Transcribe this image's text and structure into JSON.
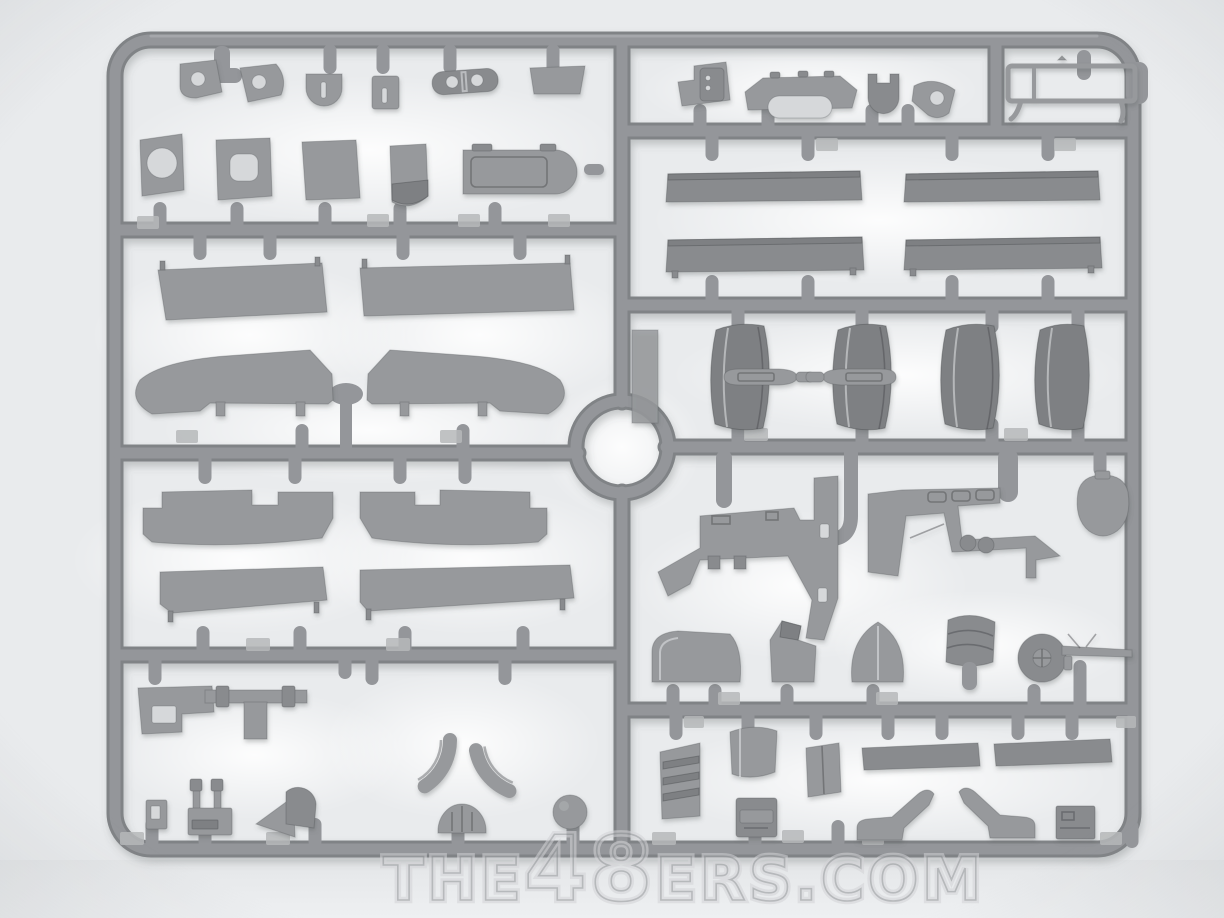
{
  "watermark": {
    "prefix": "THE",
    "number": "48",
    "suffix": "ERS.COM"
  },
  "colors": {
    "background": "#e9ebed",
    "runner": "#94969a",
    "runner-dark": "#808386",
    "runner-hi": "#aeb0b3",
    "plastic": "#97999c",
    "plastic-dark": "#898b8e",
    "plastic-darker": "#7e8083",
    "hole": "#d6d8da",
    "pad": "#b6b8ba",
    "watermark-outer": "#d2d4d6",
    "watermark-inner": "#9b9da0"
  }
}
